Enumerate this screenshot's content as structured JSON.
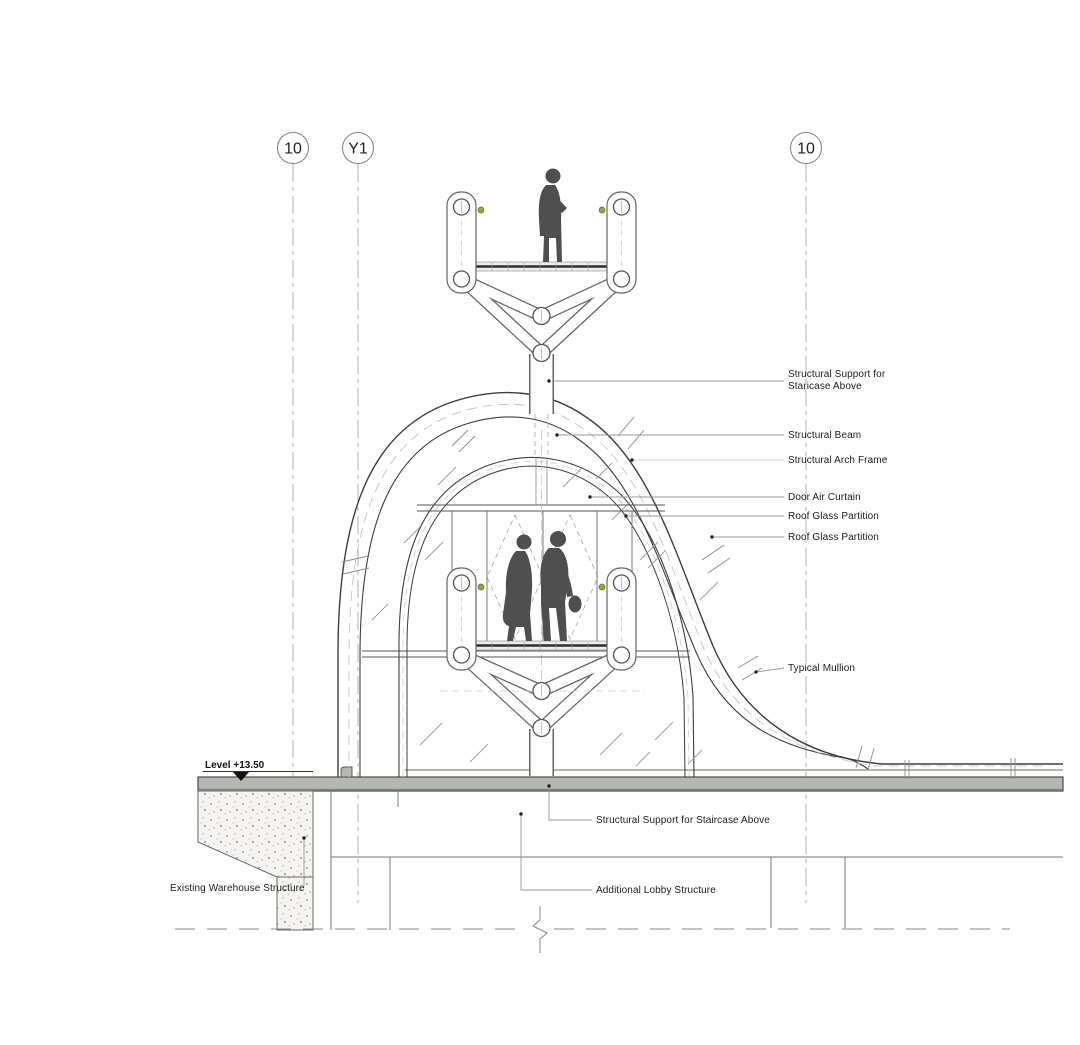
{
  "grid_markers": [
    {
      "label": "10"
    },
    {
      "label": "Y1"
    },
    {
      "label": "10"
    }
  ],
  "level_marker": {
    "label": "Level +13.50"
  },
  "callouts_right": [
    {
      "line1": "Structural Support for",
      "line2": "Staricase Above"
    },
    {
      "label": "Structural Beam"
    },
    {
      "label": "Structural Arch Frame"
    },
    {
      "label": "Door Air Curtain"
    },
    {
      "label": "Roof Glass Partition"
    },
    {
      "label": "Roof Glass Partition"
    },
    {
      "label": "Typical Mullion"
    }
  ],
  "callouts_bottom": [
    {
      "label": "Structural Support for Staircase Above"
    },
    {
      "label": "Additional Lobby Structure"
    }
  ],
  "callouts_left": [
    {
      "label": "Existing Warehouse Structure"
    }
  ],
  "colors": {
    "slab_fill": "#b5b8b2",
    "slab_accent": "#6e8078",
    "concrete_fill": "#f5f4f0",
    "silhouette": "#4f4f4f",
    "handle_dot": "#9aa23a",
    "line_dark": "#3f3f3f",
    "text": "#1d1d1d"
  }
}
